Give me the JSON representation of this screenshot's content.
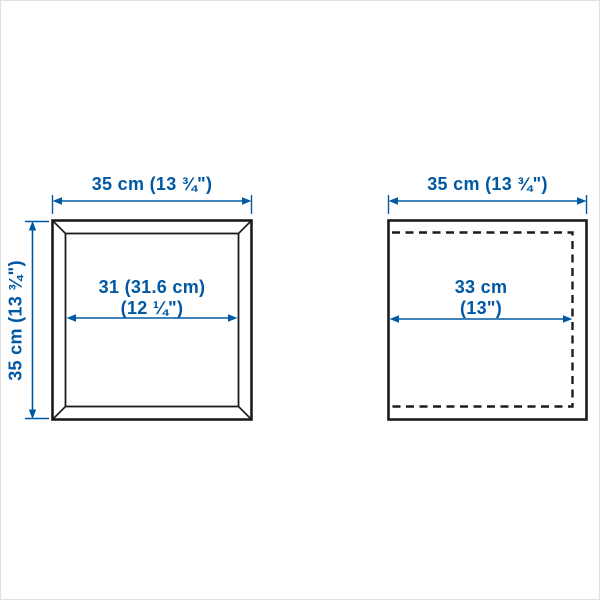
{
  "colors": {
    "accent": "#0058a3",
    "line": "#1c1c1c",
    "background": "#ffffff",
    "edge": "#e0e0e0"
  },
  "left_diagram": {
    "description": "front view of square frame with beveled edges",
    "top_dimension": "35 cm (13 ¾\")",
    "side_dimension": "35 cm (13 ¾\")",
    "inner_dimension_line1": "31 (31.6 cm)",
    "inner_dimension_line2": "(12 ¼\")"
  },
  "right_diagram": {
    "description": "square panel with dashed interior outline",
    "top_dimension": "35 cm (13 ¾\")",
    "inner_dimension_line1": "33 cm",
    "inner_dimension_line2": "(13\")"
  }
}
